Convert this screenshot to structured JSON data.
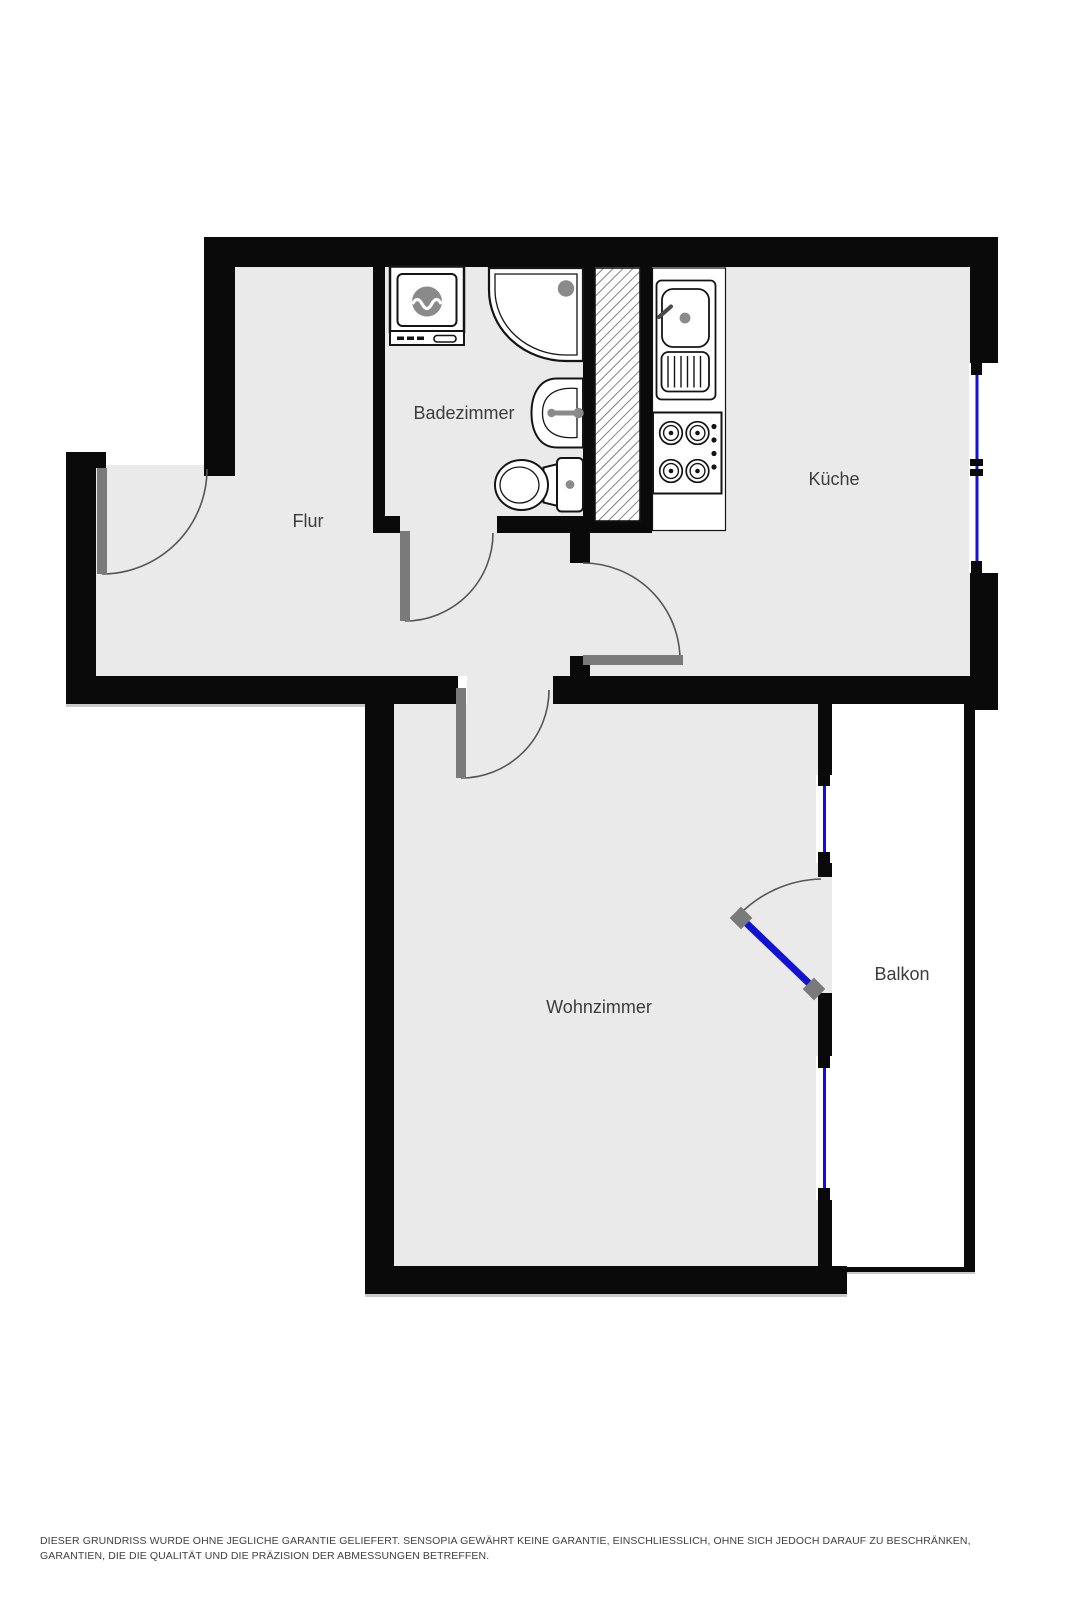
{
  "plan": {
    "rooms": [
      {
        "id": "badezimmer",
        "label": "Badezimmer"
      },
      {
        "id": "flur",
        "label": "Flur"
      },
      {
        "id": "kueche",
        "label": "Küche"
      },
      {
        "id": "wohnzimmer",
        "label": "Wohnzimmer"
      },
      {
        "id": "balkon",
        "label": "Balkon"
      }
    ],
    "fixtures": [
      "washing-machine-icon",
      "shower-icon",
      "bathroom-sink-icon",
      "toilet-icon",
      "kitchen-sink-icon",
      "stove-icon",
      "shaft-hatch-icon"
    ],
    "colors": {
      "wall": "#0a0a0a",
      "floor": "#eaeaea",
      "balcony_floor": "#ffffff",
      "window_blue": "#1212d4",
      "door_leaf_gray": "#7a7a7a",
      "door_arc": "#555555",
      "fixture_gray": "#8a8a8a",
      "hatch_line": "#5a5a5a",
      "label_text": "#3c3c3c",
      "disclaimer_text": "#414141"
    }
  },
  "disclaimer": "DIESER GRUNDRISS WURDE OHNE JEGLICHE GARANTIE GELIEFERT. SENSOPIA GEWÄHRT KEINE GARANTIE, EINSCHLIESSLICH, OHNE SICH JEDOCH DARAUF ZU BESCHRÄNKEN, GARANTIEN, DIE DIE QUALITÄT UND DIE PRÄZISION DER ABMESSUNGEN BETREFFEN."
}
